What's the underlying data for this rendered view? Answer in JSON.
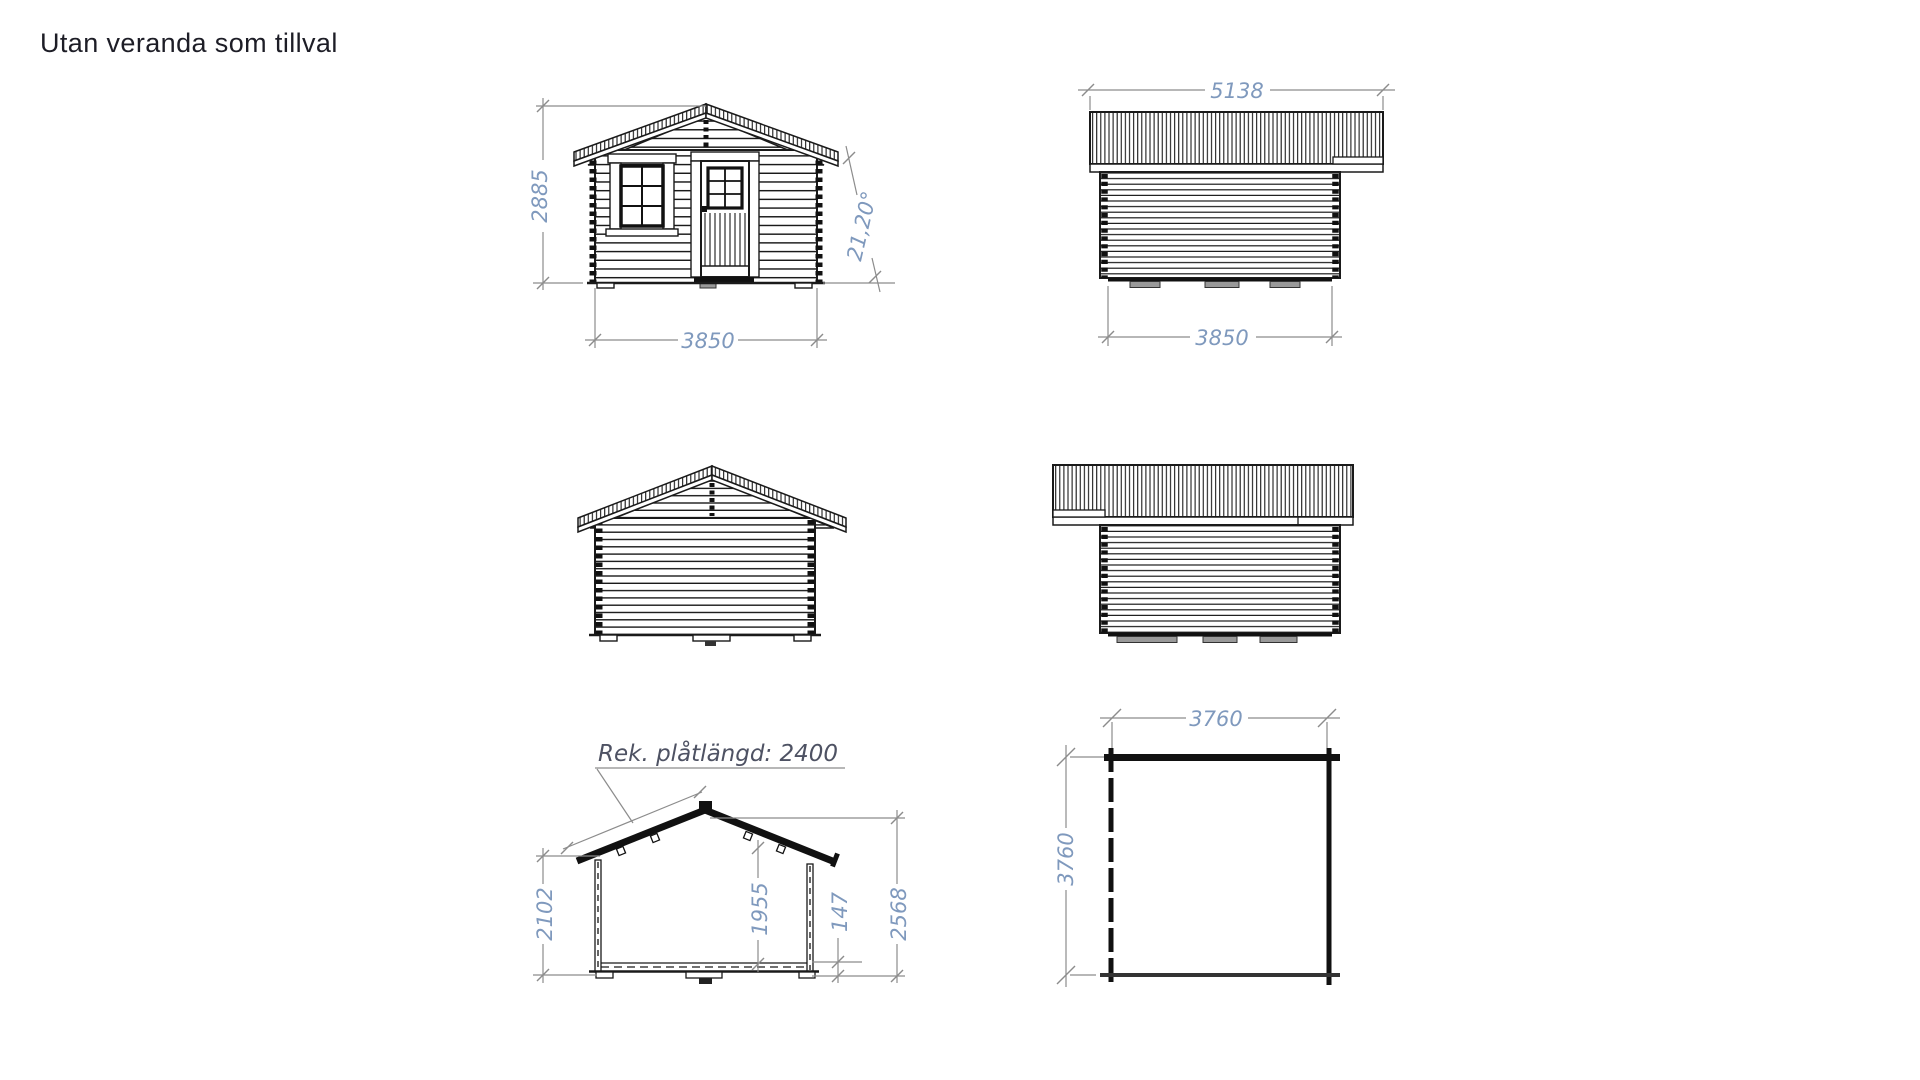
{
  "title": "Utan veranda som tillval",
  "colors": {
    "background": "#ffffff",
    "drawing_line": "#1a1a1a",
    "dimension_line": "#8c8c8c",
    "dimension_text": "#7f99bd",
    "label_text": "#4e5263",
    "title_text": "#1d1d26"
  },
  "front_elevation": {
    "height": "2885",
    "width": "3850",
    "roof_angle": "21,20°"
  },
  "side_elevation_top": {
    "roof_length": "5138",
    "width": "3850"
  },
  "cross_section": {
    "roof_sheet_label": "Rek. plåtlängd: 2400",
    "wall_height": "2102",
    "inner_height": "1955",
    "base_height": "147",
    "total_height": "2568"
  },
  "floor_plan": {
    "width": "3760",
    "depth": "3760"
  }
}
